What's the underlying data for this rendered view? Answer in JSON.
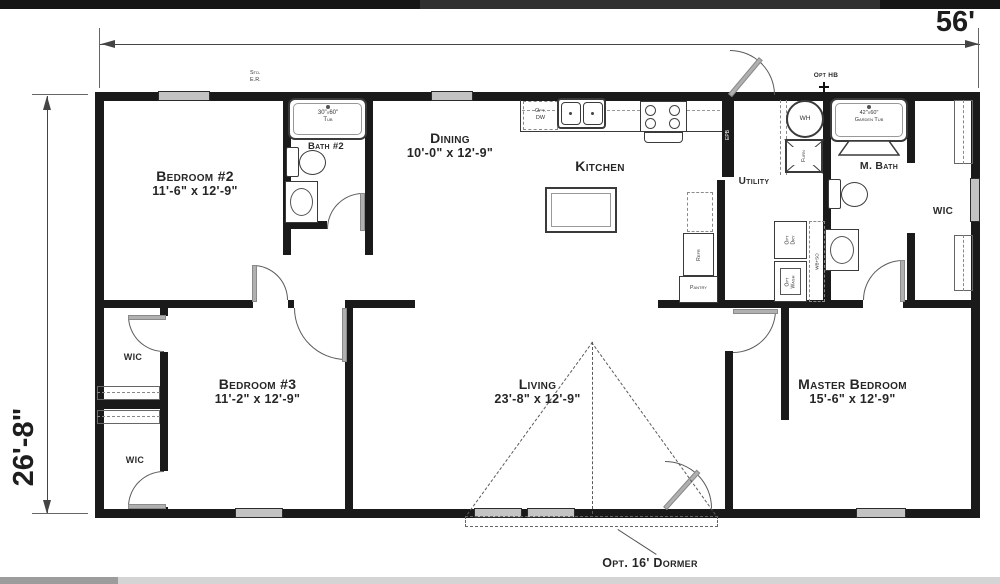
{
  "meta": {
    "title": "Floor plan",
    "canvas_width": 1000,
    "canvas_height": 584
  },
  "colors": {
    "wall": "#1a1a1a",
    "window_fill": "#c3c3c3",
    "door": "#b0b0b0",
    "text": "#2b2b2b",
    "topbar": "#151515",
    "bottombar": "#d4d4d4",
    "bottombar_left": "#9c9c9c"
  },
  "dimensions": {
    "overall_width": "56'",
    "overall_depth": "26'-8\""
  },
  "rooms": {
    "bedroom2": {
      "name": "Bedroom #2",
      "dims": "11'-6\" x 12'-9\""
    },
    "bedroom3": {
      "name": "Bedroom #3",
      "dims": "11'-2\" x 12'-9\""
    },
    "master": {
      "name": "Master Bedroom",
      "dims": "15'-6\" x 12'-9\""
    },
    "dining": {
      "name": "Dining",
      "dims": "10'-0\" x 12'-9\""
    },
    "living": {
      "name": "Living",
      "dims": "23'-8\" x 12'-9\""
    },
    "kitchen": {
      "name": "Kitchen"
    },
    "bath2": {
      "name": "Bath #2"
    },
    "master_bath": {
      "name": "M. Bath"
    },
    "utility": {
      "name": "Utility"
    },
    "wic_right": {
      "name": "WIC"
    },
    "wic_top": {
      "name": "WIC"
    },
    "wic_bottom": {
      "name": "WIC"
    }
  },
  "fixtures": {
    "tub_bath2": "30\"x60\"\nTub",
    "garden_tub": "42\"x60\"\nGarden Tub",
    "water_heater": "WH",
    "furnace": "Furn",
    "refrigerator": "Refr",
    "pantry": "Pantry",
    "dishwasher": "Opt.\nDW",
    "dryer": "Opt\nDry",
    "washer": "Opt\nWash",
    "washbox": "WB+SO"
  },
  "annotations": {
    "std_er": "Std.\nE.R.",
    "opt_hb": "Opt HB",
    "epb": "EPB",
    "dormer": "Opt. 16' Dormer"
  }
}
